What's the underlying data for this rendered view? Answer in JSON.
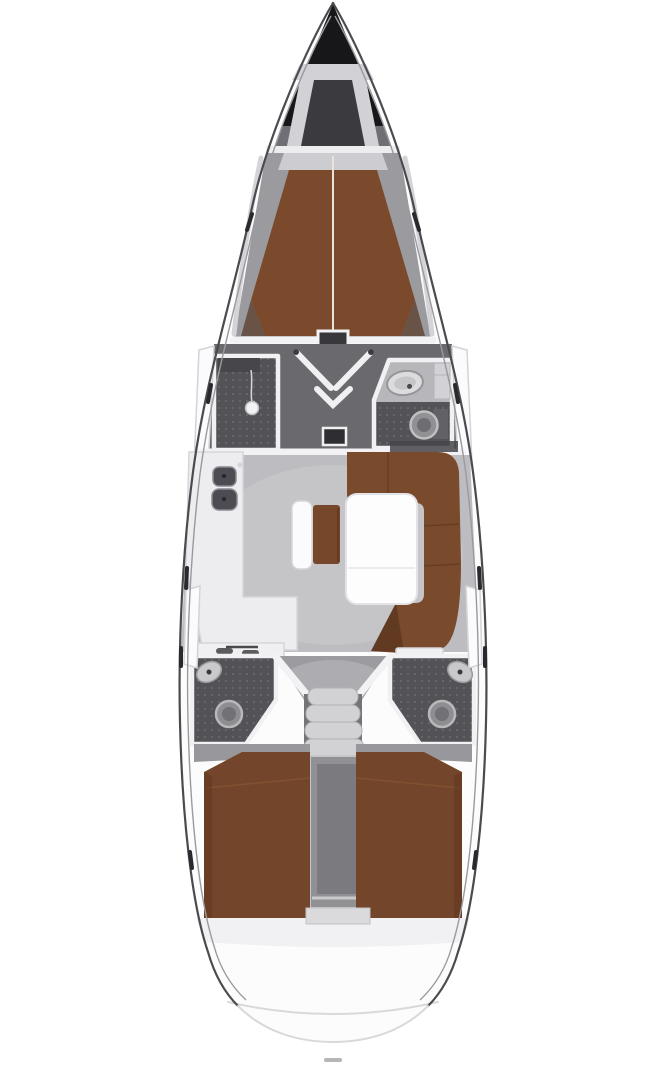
{
  "diagram": {
    "type": "yacht-interior-floor-plan",
    "view": "top-down",
    "regions": [
      "anchor-locker",
      "forward-cabin-v-berth",
      "shower-room",
      "forward-head",
      "vestibule",
      "salon",
      "galley",
      "settee",
      "u-sofa",
      "salon-table",
      "aft-head-port",
      "aft-head-starboard",
      "companionway-stairs",
      "engine-compartment",
      "aft-cabin-port",
      "aft-cabin-starboard",
      "transom"
    ]
  },
  "colors": {
    "hull": "#fcfcfc",
    "hull_outline": "#4b4b4f",
    "bow_shadow": "#6f6f75",
    "bow_tip": "#17171a",
    "anchor_well": "#3b3b3f",
    "anchor_frame": "#d2d2d6",
    "bulkhead": "#ededf0",
    "cabin_floor": "#9b9b9f",
    "shelf": "#cdcdd1",
    "berth": "#7b4a2c",
    "berth_shadow": "#4f2d19",
    "hall_floor": "#6a6a6e",
    "wet_floor": "#535357",
    "head_upper": "#b7b7bb",
    "salon_floor": "#bdbdc1",
    "galley": "#ededef",
    "sink": "#4c4c52",
    "settee_back": "#fbfbfd",
    "settee_cushion": "#76472a",
    "sofa": "#7a4a2c",
    "table": "#fdfdfe",
    "corridor_floor": "#9c9ca0",
    "step": "#d2d2d5",
    "engine_box": "#919195",
    "engine_inner": "#7b7b7f",
    "bed": "#73452a",
    "floor_strip": "#98989c",
    "aft_band": "#f1f1f3",
    "fixture": "#8e8e92",
    "porcelain": "#c9c9cc",
    "white_furniture": "#f0f0f2",
    "mat": "#2e2e32",
    "dark_strip": "#46464a"
  }
}
